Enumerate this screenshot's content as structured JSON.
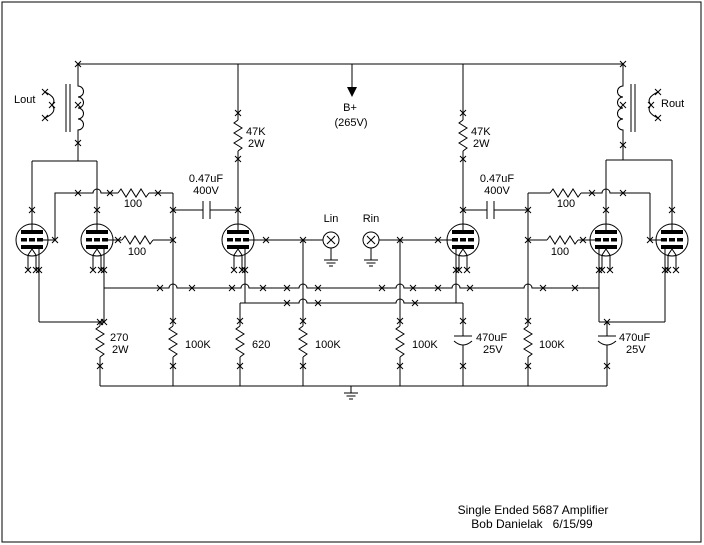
{
  "window": {
    "width": 704,
    "height": 545,
    "background": "#ffffff",
    "ink": "#000000"
  },
  "schematic": {
    "title": {
      "line1": "Single Ended 5687 Amplifier",
      "line2": "Bob Danielak   6/15/99"
    },
    "power": {
      "label": "B+",
      "voltage": "(265V)"
    },
    "outputs": {
      "left": "Lout",
      "right": "Rout"
    },
    "inputs": {
      "left": "Lin",
      "right": "Rin"
    },
    "components": {
      "r_plate_left": {
        "value": "47K",
        "rating": "2W"
      },
      "r_plate_right": {
        "value": "47K",
        "rating": "2W"
      },
      "c_couple_left": {
        "value": "0.47uF",
        "rating": "400V"
      },
      "c_couple_right": {
        "value": "0.47uF",
        "rating": "400V"
      },
      "r_stop_left_outer": {
        "value": "100"
      },
      "r_stop_left_inner": {
        "value": "100"
      },
      "r_stop_right_outer": {
        "value": "100"
      },
      "r_stop_right_inner": {
        "value": "100"
      },
      "r_cathode_output": {
        "value": "270",
        "rating": "2W"
      },
      "r_gridleak_left": {
        "value": "100K"
      },
      "r_cathode_driver": {
        "value": "620"
      },
      "r_input_left": {
        "value": "100K"
      },
      "r_input_right": {
        "value": "100K"
      },
      "c_bypass_driver": {
        "value": "470uF",
        "rating": "25V"
      },
      "r_gridleak_right": {
        "value": "100K"
      },
      "c_bypass_output": {
        "value": "470uF",
        "rating": "25V"
      }
    }
  }
}
